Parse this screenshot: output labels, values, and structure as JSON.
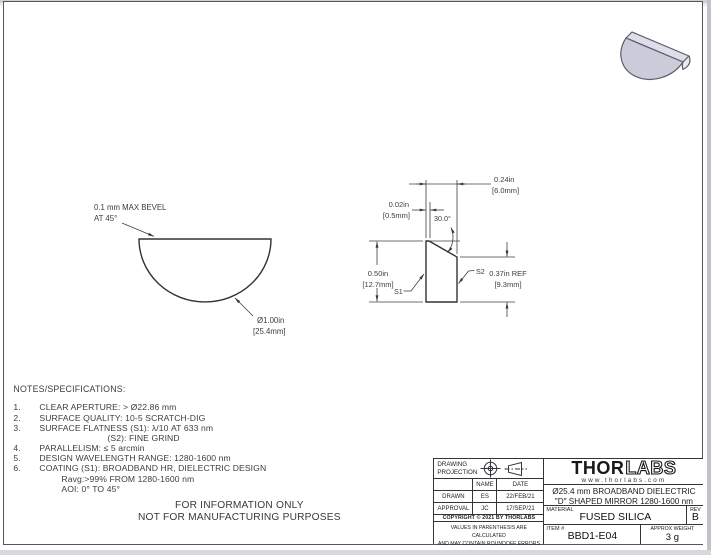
{
  "colors": {
    "line": "#333338",
    "dim_line": "#3f3f44",
    "part_fill": "#cbccd9",
    "part_fill_top": "#dddeea",
    "part_fill_back": "#e9e9f5",
    "part_edge": "#5d5d6a"
  },
  "front_view": {
    "bevel_note_1": "0.1 mm MAX BEVEL",
    "bevel_note_2": "AT 45°",
    "dia_1": "Ø1.00in",
    "dia_2": "[25.4mm]"
  },
  "side_view": {
    "width_in": "0.24in",
    "width_mm": "[6.0mm]",
    "flat_in": "0.02in",
    "flat_mm": "[0.5mm]",
    "angle": "30.0°",
    "height_in": "0.50in",
    "height_mm": "[12.7mm]",
    "back_in": "0.37in  REF",
    "back_mm": "[9.3mm]",
    "s1": "S1",
    "s2": "S2"
  },
  "notes": {
    "heading": "NOTES/SPECIFICATIONS:",
    "rows": [
      {
        "num": "1.",
        "text": "CLEAR APERTURE: > Ø22.86 mm"
      },
      {
        "num": "2.",
        "text": "SURFACE QUALITY: 10-5 SCRATCH-DIG"
      },
      {
        "num": "3.",
        "text": "SURFACE FLATNESS (S1): λ/10 AT 633 nm"
      },
      {
        "num": "",
        "text": "(S2): FINE GRIND"
      },
      {
        "num": "4.",
        "text": "PARALLELISM: ≤ 5 arcmin"
      },
      {
        "num": "5.",
        "text": "DESIGN WAVELENGTH RANGE: 1280-1600 nm"
      },
      {
        "num": "6.",
        "text": "COATING (S1): BROADBAND HR, DIELECTRIC DESIGN"
      },
      {
        "num": "",
        "text": "Ravg:>99% FROM 1280-1600 nm"
      },
      {
        "num": "",
        "text": "AOI: 0° TO 45°"
      }
    ]
  },
  "footer": {
    "line1": "FOR INFORMATION ONLY",
    "line2": "NOT FOR MANUFACTURING PURPOSES"
  },
  "title_block": {
    "projection_label_1": "DRAWING",
    "projection_label_2": "PROJECTION",
    "col_name": "NAME",
    "col_date": "DATE",
    "drawn_label": "DRAWN",
    "drawn_name": "ES",
    "drawn_date": "22/FEB/21",
    "approval_label": "APPROVAL",
    "approval_name": "JC",
    "approval_date": "17/SEP/21",
    "copyright": "COPYRIGHT © 2021 BY THORLABS",
    "disclaimer_1": "VALUES IN PARENTHESIS ARE CALCULATED",
    "disclaimer_2": "AND MAY CONTAIN ROUNDOFF ERRORS",
    "logo_thor": "THOR",
    "logo_labs": "LABS",
    "website": "www.thorlabs.com",
    "product_title_1": "Ø25.4 mm BROADBAND DIELECTRIC",
    "product_title_2": "\"D\" SHAPED MIRROR 1280-1600 nm",
    "material_label": "MATERIAL",
    "material": "FUSED SILICA",
    "rev_label": "REV",
    "rev": "B",
    "item_label": "ITEM #",
    "item": "BBD1-E04",
    "weight_label": "APPROX WEIGHT",
    "weight": "3 g"
  }
}
